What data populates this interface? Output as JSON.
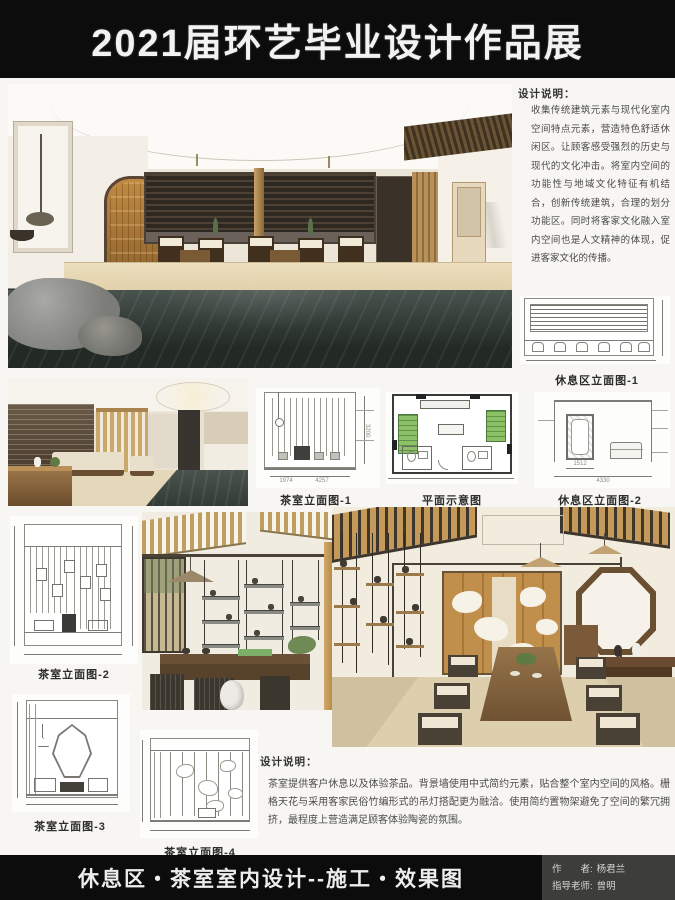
{
  "header": {
    "title": "2021届环艺毕业设计作品展"
  },
  "notes": {
    "top": {
      "heading": "设计说明：",
      "body": "收集传统建筑元素与现代化室内空间特点元素，营造特色舒适休闲区。让顾客感受强烈的历史与现代的文化冲击。将室内空间的功能性与地域文化特征有机结合，创新传统建筑，合理的划分功能区。同时将客家文化融入室内空间也是人文精神的体现，促进客家文化的传播。"
    },
    "bottom": {
      "heading": "设计说明：",
      "body": "茶室提供客户休息以及体验茶品。背景墙使用中式简约元素，贴合整个室内空间的风格。栅格天花与采用客家民俗竹编形式的吊灯搭配更为融洽。使用简约置物架避免了空间的繁冗拥挤，最程度上营造满足顾客体验陶瓷的氛围。"
    }
  },
  "captions": {
    "rest_elev_1": "休息区立面图-1",
    "tea_elev_1": "茶室立面图-1",
    "floor_plan": "平面示意图",
    "rest_elev_2": "休息区立面图-2",
    "tea_elev_2": "茶室立面图-2",
    "tea_elev_3": "茶室立面图-3",
    "tea_elev_4": "茶室立面图-4"
  },
  "dims": {
    "tea1_w1": "1974",
    "tea1_w2": "4257",
    "tea1_h": "3200",
    "rest2_w1": "1512",
    "rest2_w2": "4330"
  },
  "footer": {
    "title": "休息区・茶室室内设计--施工・效果图",
    "author_label": "作　　者:",
    "author_name": "杨君兰",
    "advisor_label": "指导老师:",
    "advisor_name": "曾明"
  },
  "colors": {
    "bar_bg": "#0c0c0c",
    "credit_bg": "#3d3d3b",
    "plan_green": "#8cc167",
    "wood_accent": "#c59a58",
    "marble_dark": "#2f3733"
  }
}
